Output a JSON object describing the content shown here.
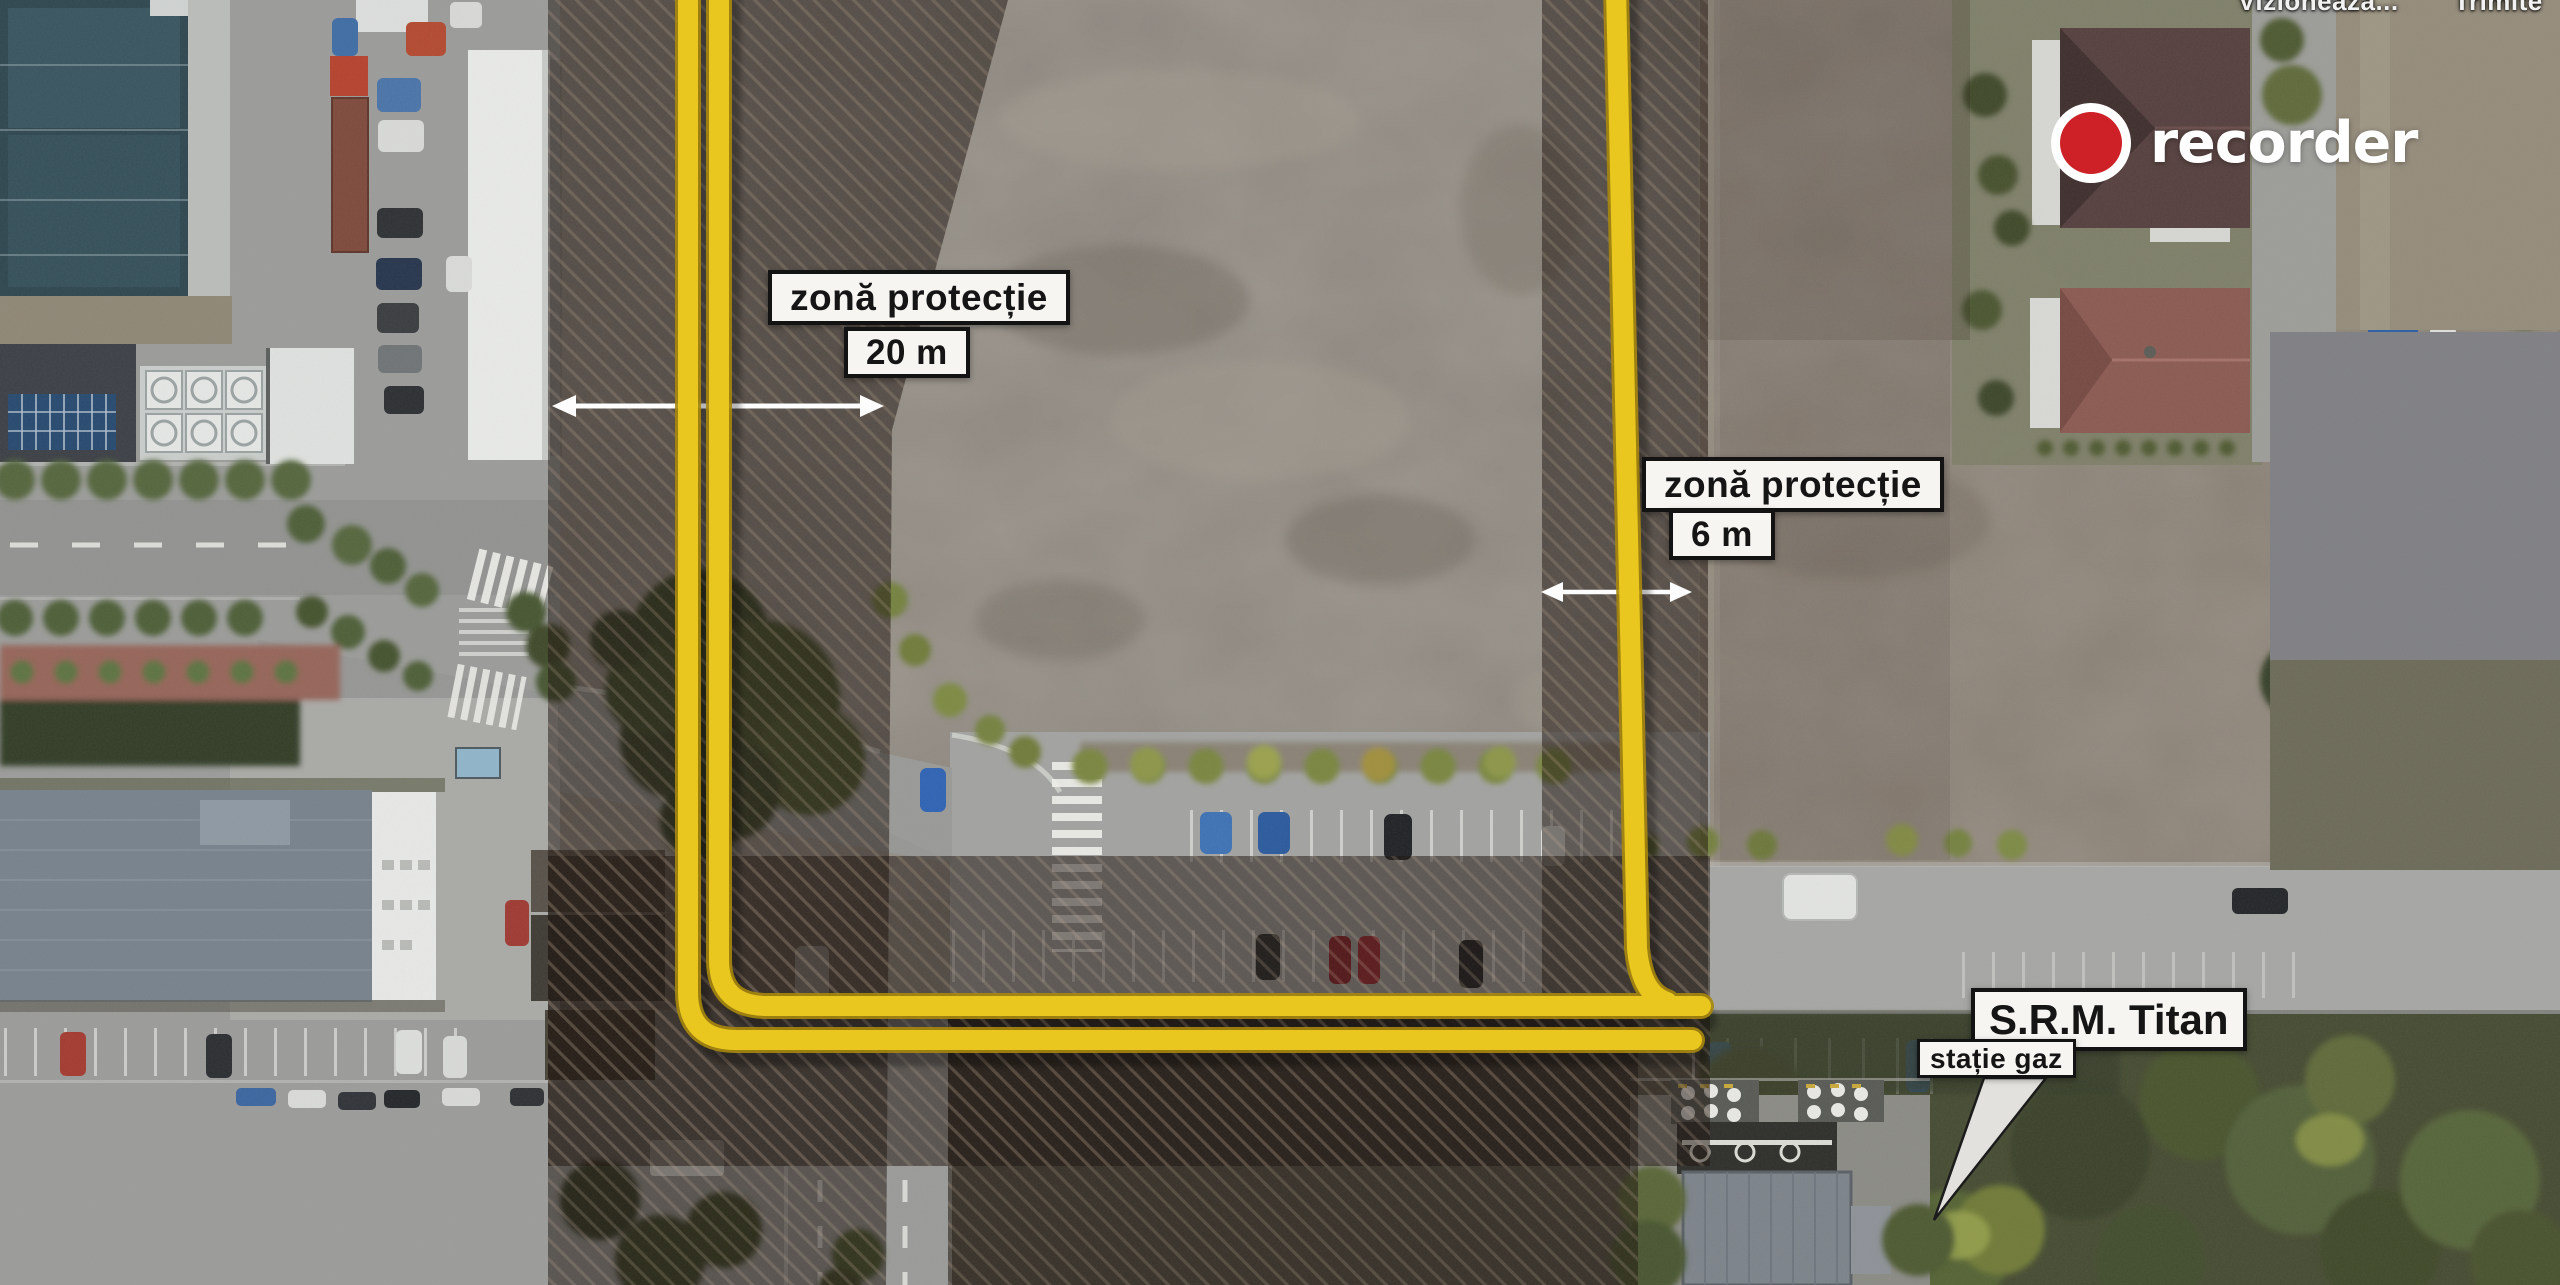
{
  "overlay_links": {
    "watch": "Vizionează...",
    "share": "Trimite"
  },
  "brand": {
    "name": "recorder"
  },
  "annotations": {
    "zone_20m": {
      "title": "zonă protecție",
      "value": "20 m"
    },
    "zone_6m": {
      "title": "zonă protecție",
      "value": "6 m"
    },
    "station": {
      "title": "S.R.M. Titan",
      "subtitle": "stație gaz"
    }
  },
  "colors": {
    "pipe_yellow": "#e9c71f",
    "recorder_red": "#ce2127",
    "label_bg": "#f6f5f2",
    "label_border": "#131313",
    "label_text": "#151515",
    "arrow_white": "#fdfdfd"
  }
}
